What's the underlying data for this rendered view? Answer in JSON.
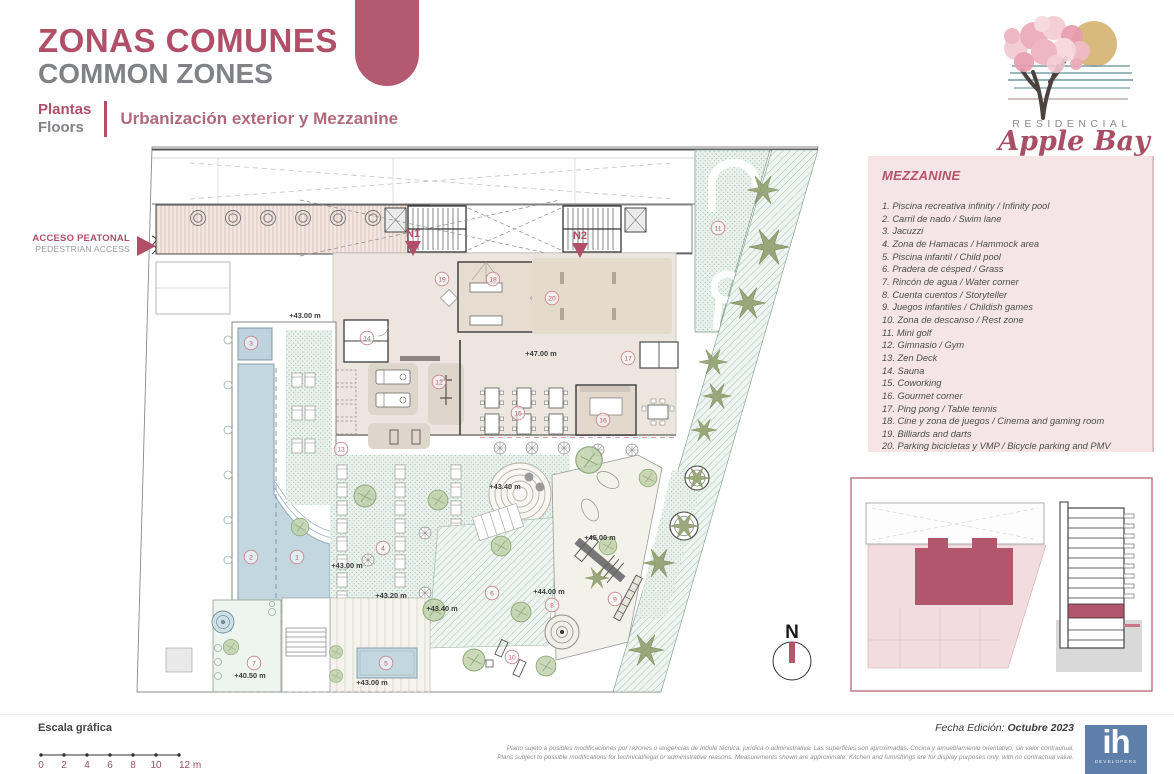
{
  "header": {
    "title_es": "ZONAS COMUNES",
    "title_en": "COMMON ZONES",
    "floors_es": "Plantas",
    "floors_en": "Floors",
    "subtitle": "Urbanización exterior y Mezzanine"
  },
  "brand": {
    "residencial": "RESIDENCIAL",
    "name": "Apple Bay"
  },
  "access": {
    "es": "ACCESO PEATONAL",
    "en": "PEDESTRIAN ACCESS"
  },
  "legend": {
    "title": "MEZZANINE",
    "items": [
      "1. Piscina recreativa infinity / Infinity pool",
      "2. Carril de nado / Swim lane",
      "3. Jacuzzi",
      "4. Zona de Hamacas / Hammock area",
      "5. Piscina infantil / Child pool",
      "6. Pradera de césped / Grass",
      "7. Rincón de agua / Water corner",
      "8. Cuenta cuentos / Storyteller",
      "9. Juegos infantiles / Childish games",
      "10. Zona de descanso / Rest zone",
      "11. Mini golf",
      "12. Gimnasio / Gym",
      "13. Zen Deck",
      "14. Sauna",
      "15. Coworking",
      "16. Gourmet corner",
      "17. Ping pong / Table tennis",
      "18. Cine y zona de juegos / Cinema and gaming room",
      "19. Billiards and darts",
      "20. Parking bicicletas y VMP / Bicycle parking and PMV"
    ]
  },
  "plan": {
    "north": "N",
    "stairs": [
      {
        "label": "N1"
      },
      {
        "label": "N2"
      }
    ],
    "markers": [
      {
        "n": "1",
        "x": 297,
        "y": 557
      },
      {
        "n": "2",
        "x": 251,
        "y": 557
      },
      {
        "n": "3",
        "x": 251,
        "y": 343
      },
      {
        "n": "4",
        "x": 383,
        "y": 548
      },
      {
        "n": "5",
        "x": 386,
        "y": 663
      },
      {
        "n": "6",
        "x": 492,
        "y": 593
      },
      {
        "n": "7",
        "x": 254,
        "y": 663
      },
      {
        "n": "8",
        "x": 552,
        "y": 605
      },
      {
        "n": "9",
        "x": 615,
        "y": 599
      },
      {
        "n": "10",
        "x": 512,
        "y": 657
      },
      {
        "n": "11",
        "x": 718,
        "y": 228
      },
      {
        "n": "12",
        "x": 439,
        "y": 382
      },
      {
        "n": "13",
        "x": 341,
        "y": 449
      },
      {
        "n": "14",
        "x": 367,
        "y": 338
      },
      {
        "n": "15",
        "x": 518,
        "y": 413
      },
      {
        "n": "16",
        "x": 603,
        "y": 420
      },
      {
        "n": "17",
        "x": 628,
        "y": 358
      },
      {
        "n": "18",
        "x": 493,
        "y": 279
      },
      {
        "n": "19",
        "x": 442,
        "y": 279
      },
      {
        "n": "20",
        "x": 552,
        "y": 298
      }
    ],
    "elevations": [
      {
        "t": "+43.00 m",
        "x": 305,
        "y": 318
      },
      {
        "t": "+47.00 m",
        "x": 541,
        "y": 356
      },
      {
        "t": "+43.40 m",
        "x": 505,
        "y": 489
      },
      {
        "t": "+45.00 m",
        "x": 600,
        "y": 540
      },
      {
        "t": "+43.00 m",
        "x": 347,
        "y": 568
      },
      {
        "t": "+43.20 m",
        "x": 391,
        "y": 598
      },
      {
        "t": "+43.40 m",
        "x": 442,
        "y": 611
      },
      {
        "t": "+44.00 m",
        "x": 549,
        "y": 594
      },
      {
        "t": "+40.50 m",
        "x": 250,
        "y": 678
      },
      {
        "t": "+43.00 m",
        "x": 372,
        "y": 685
      }
    ]
  },
  "footer": {
    "scale_title": "Escala gráfica",
    "scale_ticks": [
      "0",
      "2",
      "4",
      "6",
      "8",
      "10",
      "12 m"
    ],
    "edition_label": "Fecha Edición:",
    "edition_value": "Octubre 2023",
    "disclaimer_es": "Plano sujeto a posibles modificaciones por razones o exigencias de índole técnica,  jurídica o administrativa. Las superficies son aproximadas. Cocina y amueblamiento orientativo, sin valor contractual.",
    "disclaimer_en": "Plans subject to possible modifications for technical/legal or administrative reasons. Measurements shown are approximate. Kitchen and furnishings are for display purposes only, with no contractual value.",
    "developer": "ih",
    "developer_sub": "DEVELOPERS"
  }
}
